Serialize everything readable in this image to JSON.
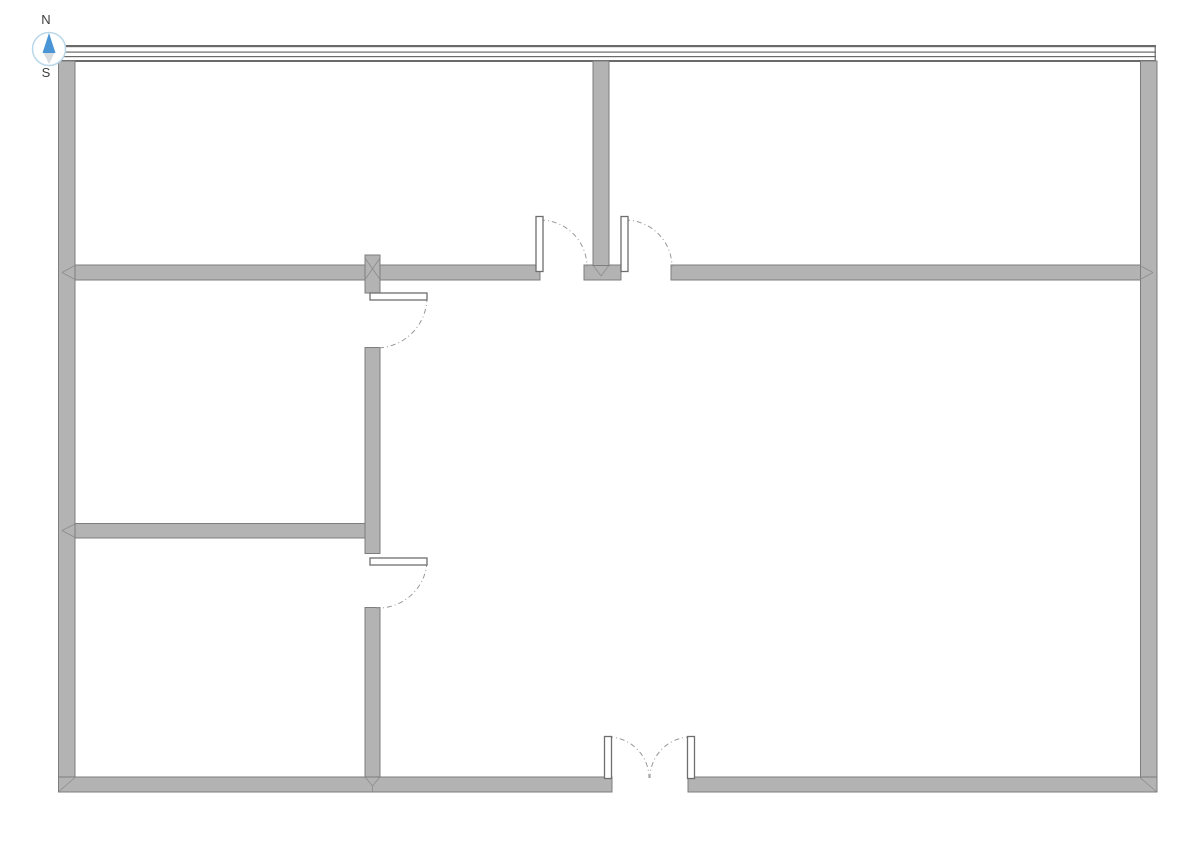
{
  "compass": {
    "north_label": "N",
    "south_label": "S",
    "cx": 49,
    "cy": 49,
    "r": 16.5,
    "ring_color": "#b9d7ea",
    "needle_north_color": "#4a95d6",
    "needle_south_color": "#d9dde0",
    "label_color": "#3d3d3d"
  },
  "palette": {
    "background": "#ffffff",
    "wall_fill": "#b3b3b3",
    "wall_stroke": "#7d7d7d",
    "top_wall_line": "#6a6a6a",
    "door_leaf_fill": "#ffffff",
    "door_leaf_stroke": "#6e6e6e",
    "door_arc": "#9a9a9a",
    "junction_line": "#8c8c8c"
  },
  "floor_plan": {
    "canvas": {
      "width": 1191,
      "height": 842
    },
    "north_wall": {
      "x1": 58.5,
      "x2": 1156,
      "lines": [
        {
          "y": 45,
          "h": 2.2
        },
        {
          "y": 51.5,
          "h": 1.2
        },
        {
          "y": 56,
          "h": 1.2
        },
        {
          "y": 60,
          "h": 2
        }
      ],
      "caps": [
        {
          "x": 58.8,
          "y1": 45,
          "y2": 62
        },
        {
          "x": 1155.2,
          "y1": 45,
          "y2": 62
        }
      ]
    },
    "walls": [
      {
        "name": "left-exterior-wall",
        "x": 58.5,
        "y": 61,
        "w": 16.5,
        "h": 731
      },
      {
        "name": "right-exterior-wall",
        "x": 1140.5,
        "y": 61,
        "w": 16.5,
        "h": 731
      },
      {
        "name": "south-wall-left-segment",
        "x": 58.5,
        "y": 777,
        "w": 553.5,
        "h": 15
      },
      {
        "name": "south-wall-right-segment",
        "x": 688,
        "y": 777,
        "w": 469,
        "h": 15
      },
      {
        "name": "middle-wall-left-segment",
        "x": 75,
        "y": 265,
        "w": 465,
        "h": 15
      },
      {
        "name": "middle-wall-center-stub",
        "x": 584,
        "y": 265,
        "w": 37,
        "h": 15
      },
      {
        "name": "middle-wall-right-segment",
        "x": 671,
        "y": 265,
        "w": 469.5,
        "h": 15
      },
      {
        "name": "top-center-partition-wall",
        "x": 593,
        "y": 61,
        "w": 16,
        "h": 204.5
      },
      {
        "name": "interior-vertical-wall-upper",
        "x": 365,
        "y": 255,
        "w": 15,
        "h": 38
      },
      {
        "name": "interior-vertical-wall-middle",
        "x": 365,
        "y": 347.5,
        "w": 15,
        "h": 206
      },
      {
        "name": "interior-vertical-wall-lower",
        "x": 365,
        "y": 607.5,
        "w": 15,
        "h": 169.5
      },
      {
        "name": "lower-horizontal-wall",
        "x": 75,
        "y": 523.5,
        "w": 290,
        "h": 14.5
      }
    ],
    "junction_marks": [
      {
        "x1": 62,
        "y1": 272.5,
        "x2": 75,
        "y2": 265.5
      },
      {
        "x1": 62,
        "y1": 272.5,
        "x2": 75,
        "y2": 279.5
      },
      {
        "x1": 1153,
        "y1": 272.5,
        "x2": 1140,
        "y2": 265.5
      },
      {
        "x1": 1153,
        "y1": 272.5,
        "x2": 1140,
        "y2": 279.5
      },
      {
        "x1": 62,
        "y1": 530.5,
        "x2": 75,
        "y2": 524
      },
      {
        "x1": 62,
        "y1": 530.5,
        "x2": 75,
        "y2": 537.5
      },
      {
        "x1": 365,
        "y1": 258,
        "x2": 380,
        "y2": 279.5
      },
      {
        "x1": 365,
        "y1": 279.5,
        "x2": 380,
        "y2": 258
      },
      {
        "x1": 593.5,
        "y1": 266,
        "x2": 601,
        "y2": 276
      },
      {
        "x1": 608.5,
        "y1": 266,
        "x2": 601,
        "y2": 276
      },
      {
        "x1": 365.5,
        "y1": 777.5,
        "x2": 372.5,
        "y2": 786
      },
      {
        "x1": 379.5,
        "y1": 777.5,
        "x2": 372.5,
        "y2": 786
      },
      {
        "x1": 372.5,
        "y1": 786,
        "x2": 372.5,
        "y2": 791.5
      },
      {
        "x1": 58.8,
        "y1": 791.5,
        "x2": 75,
        "y2": 777.5
      },
      {
        "x1": 1156.2,
        "y1": 791.5,
        "x2": 1140,
        "y2": 777.5
      }
    ],
    "doors": [
      {
        "name": "hall-door-left",
        "leaf": {
          "x": 536,
          "y": 216.5,
          "w": 7,
          "h": 55
        },
        "arc": "M 540 220 A 47 47 0 0 1 587 267"
      },
      {
        "name": "hall-door-right",
        "leaf": {
          "x": 621,
          "y": 216.5,
          "w": 7,
          "h": 55
        },
        "arc": "M 625 220 A 47 47 0 0 1 672 267"
      },
      {
        "name": "room-door-upper",
        "leaf": {
          "x": 370,
          "y": 293,
          "w": 57,
          "h": 7
        },
        "arc": "M 427 297 A 51 51 0 0 1 376 348"
      },
      {
        "name": "room-door-lower",
        "leaf": {
          "x": 370,
          "y": 558,
          "w": 57,
          "h": 7
        },
        "arc": "M 427 562 A 49 49 0 0 1 376 608"
      },
      {
        "name": "entry-double-door-left",
        "leaf": {
          "x": 604.5,
          "y": 736.5,
          "w": 7,
          "h": 42
        },
        "arc": "M 608 737 A 41 41 0 0 1 649 778"
      },
      {
        "name": "entry-double-door-right",
        "leaf": {
          "x": 687.5,
          "y": 736.5,
          "w": 7,
          "h": 42
        },
        "arc": "M 691 737 A 41 41 0 0 0 650 778"
      }
    ]
  }
}
